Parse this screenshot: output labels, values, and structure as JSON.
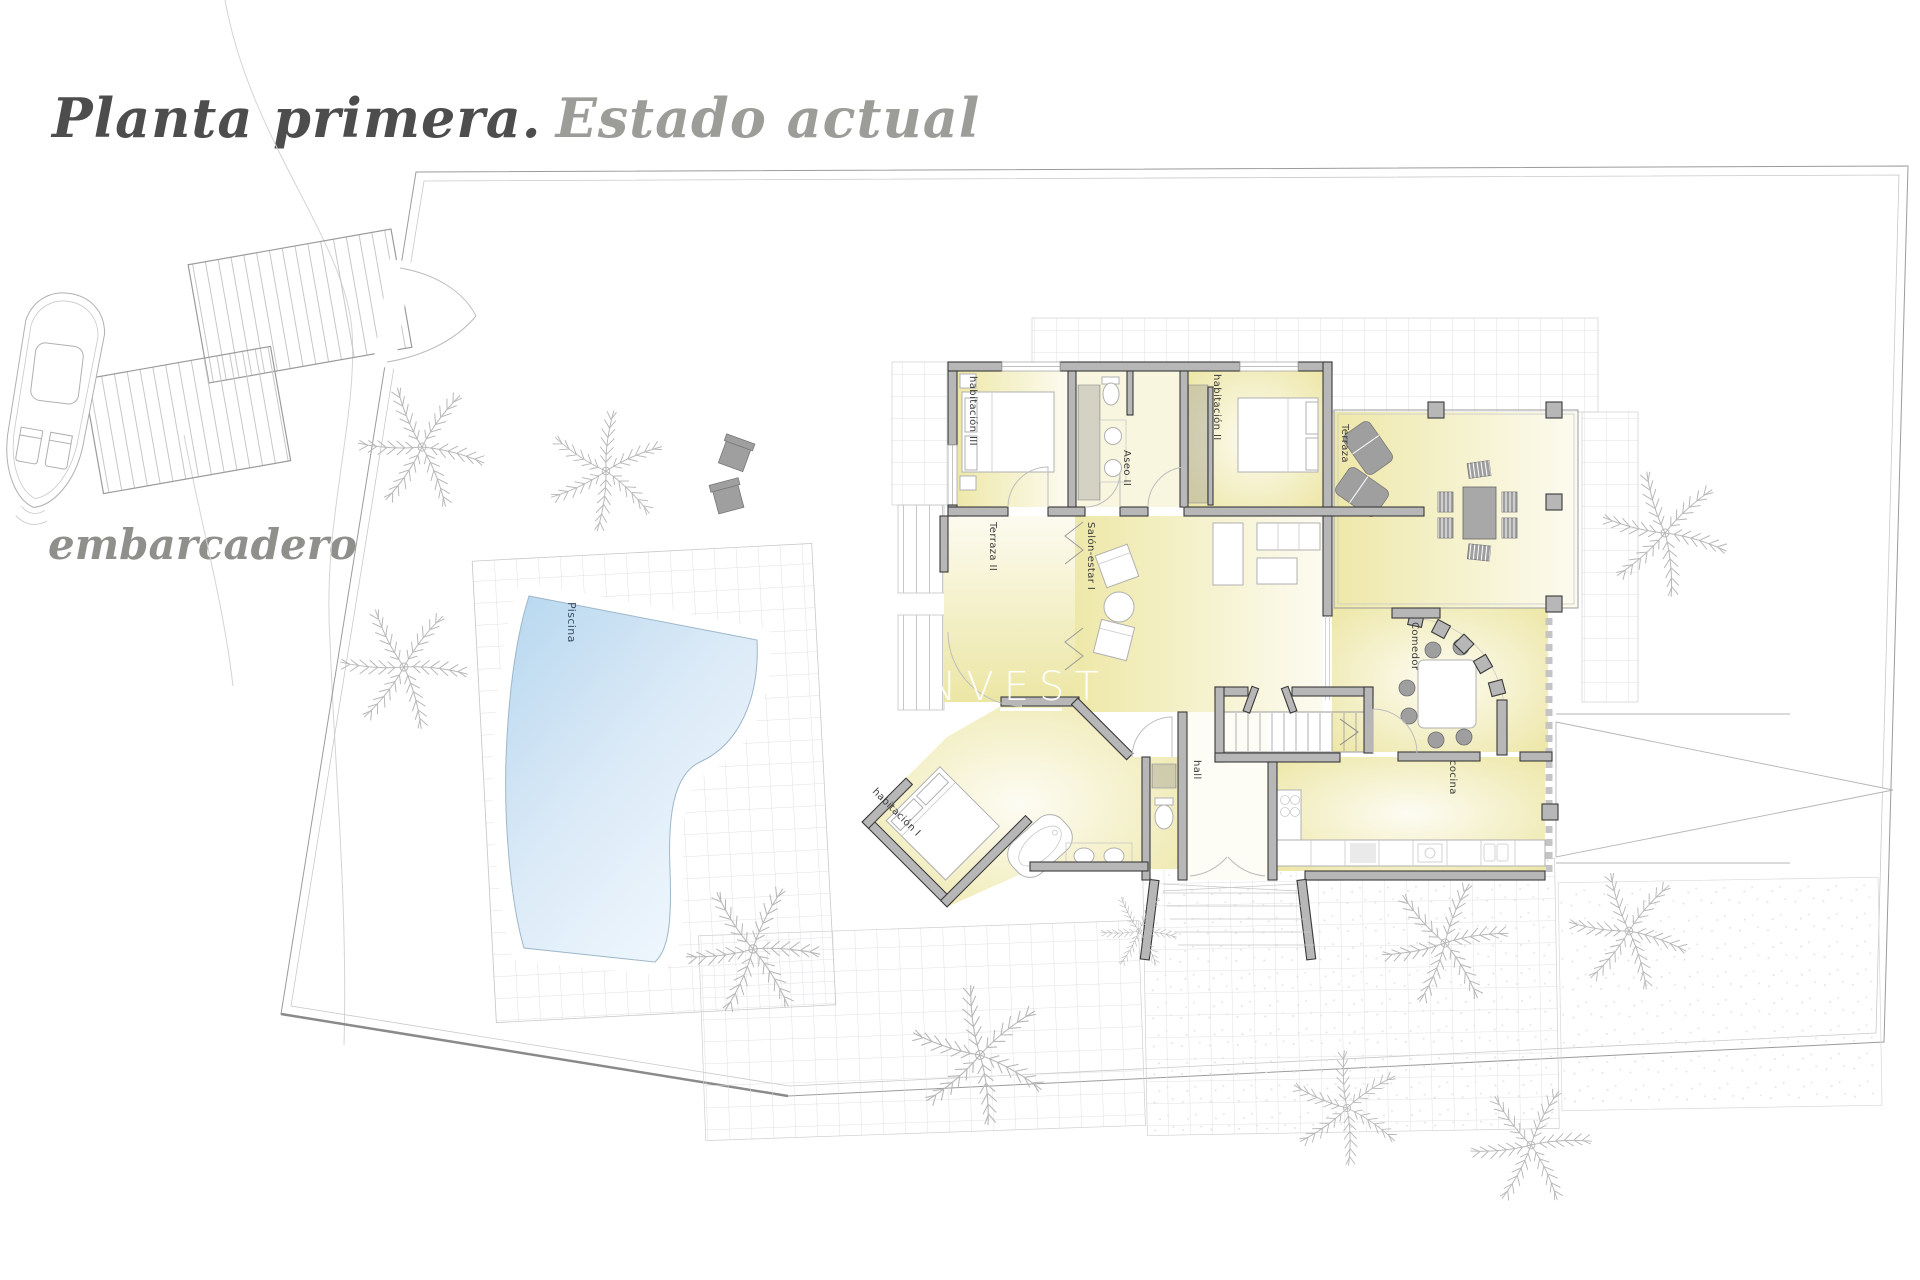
{
  "title": {
    "primary": "Planta primera.",
    "secondary": "Estado actual"
  },
  "site": {
    "dock_label": "embarcadero"
  },
  "watermark": {
    "text": "N INVEST"
  },
  "rooms": {
    "habitacion3": "habitación III",
    "aseo2": "Aseo II",
    "habitacion2": "habitación II",
    "terraza": "Terraza",
    "terraza2": "Terraza II",
    "salon_estar": "Salón-estar I",
    "comedor": "Comedor",
    "hall": "hall",
    "cocina": "cocina",
    "habitacion1": "habitación I",
    "piscina": "Piscina"
  },
  "colors": {
    "wall_fill": "#b7b7b7",
    "wall_stroke": "#3a3a3a",
    "room_yellow": "#efe9ab",
    "pool_blue": "#b7d7ef",
    "title_dark": "#4d4d4d",
    "title_light": "#9c9c98",
    "line_gray": "#9b9b9b"
  }
}
